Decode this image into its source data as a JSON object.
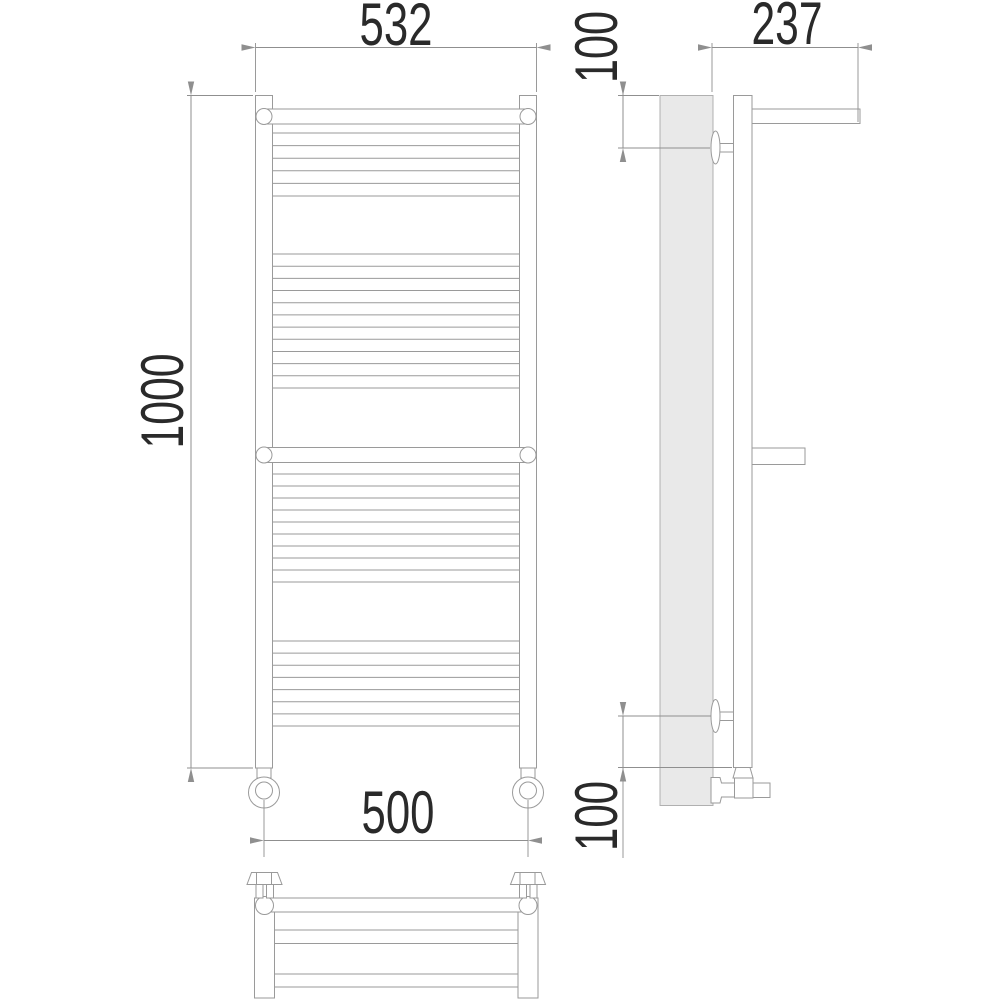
{
  "drawing": {
    "kind": "heated-towel-rail-technical-drawing",
    "dimensions": {
      "top_width": "532",
      "overall_height": "1000",
      "connection_spacing": "500",
      "depth": "237",
      "top_bracket_offset": "100",
      "bottom_bracket_offset": "100"
    },
    "colors": {
      "background": "#ffffff",
      "object_line": "#9a9a9a",
      "dimension_line": "#8f8f8f",
      "text_color": "#2a2a2a",
      "wall_fill": "#e9e9e9",
      "wall_stroke": "#b0b0b0"
    }
  }
}
